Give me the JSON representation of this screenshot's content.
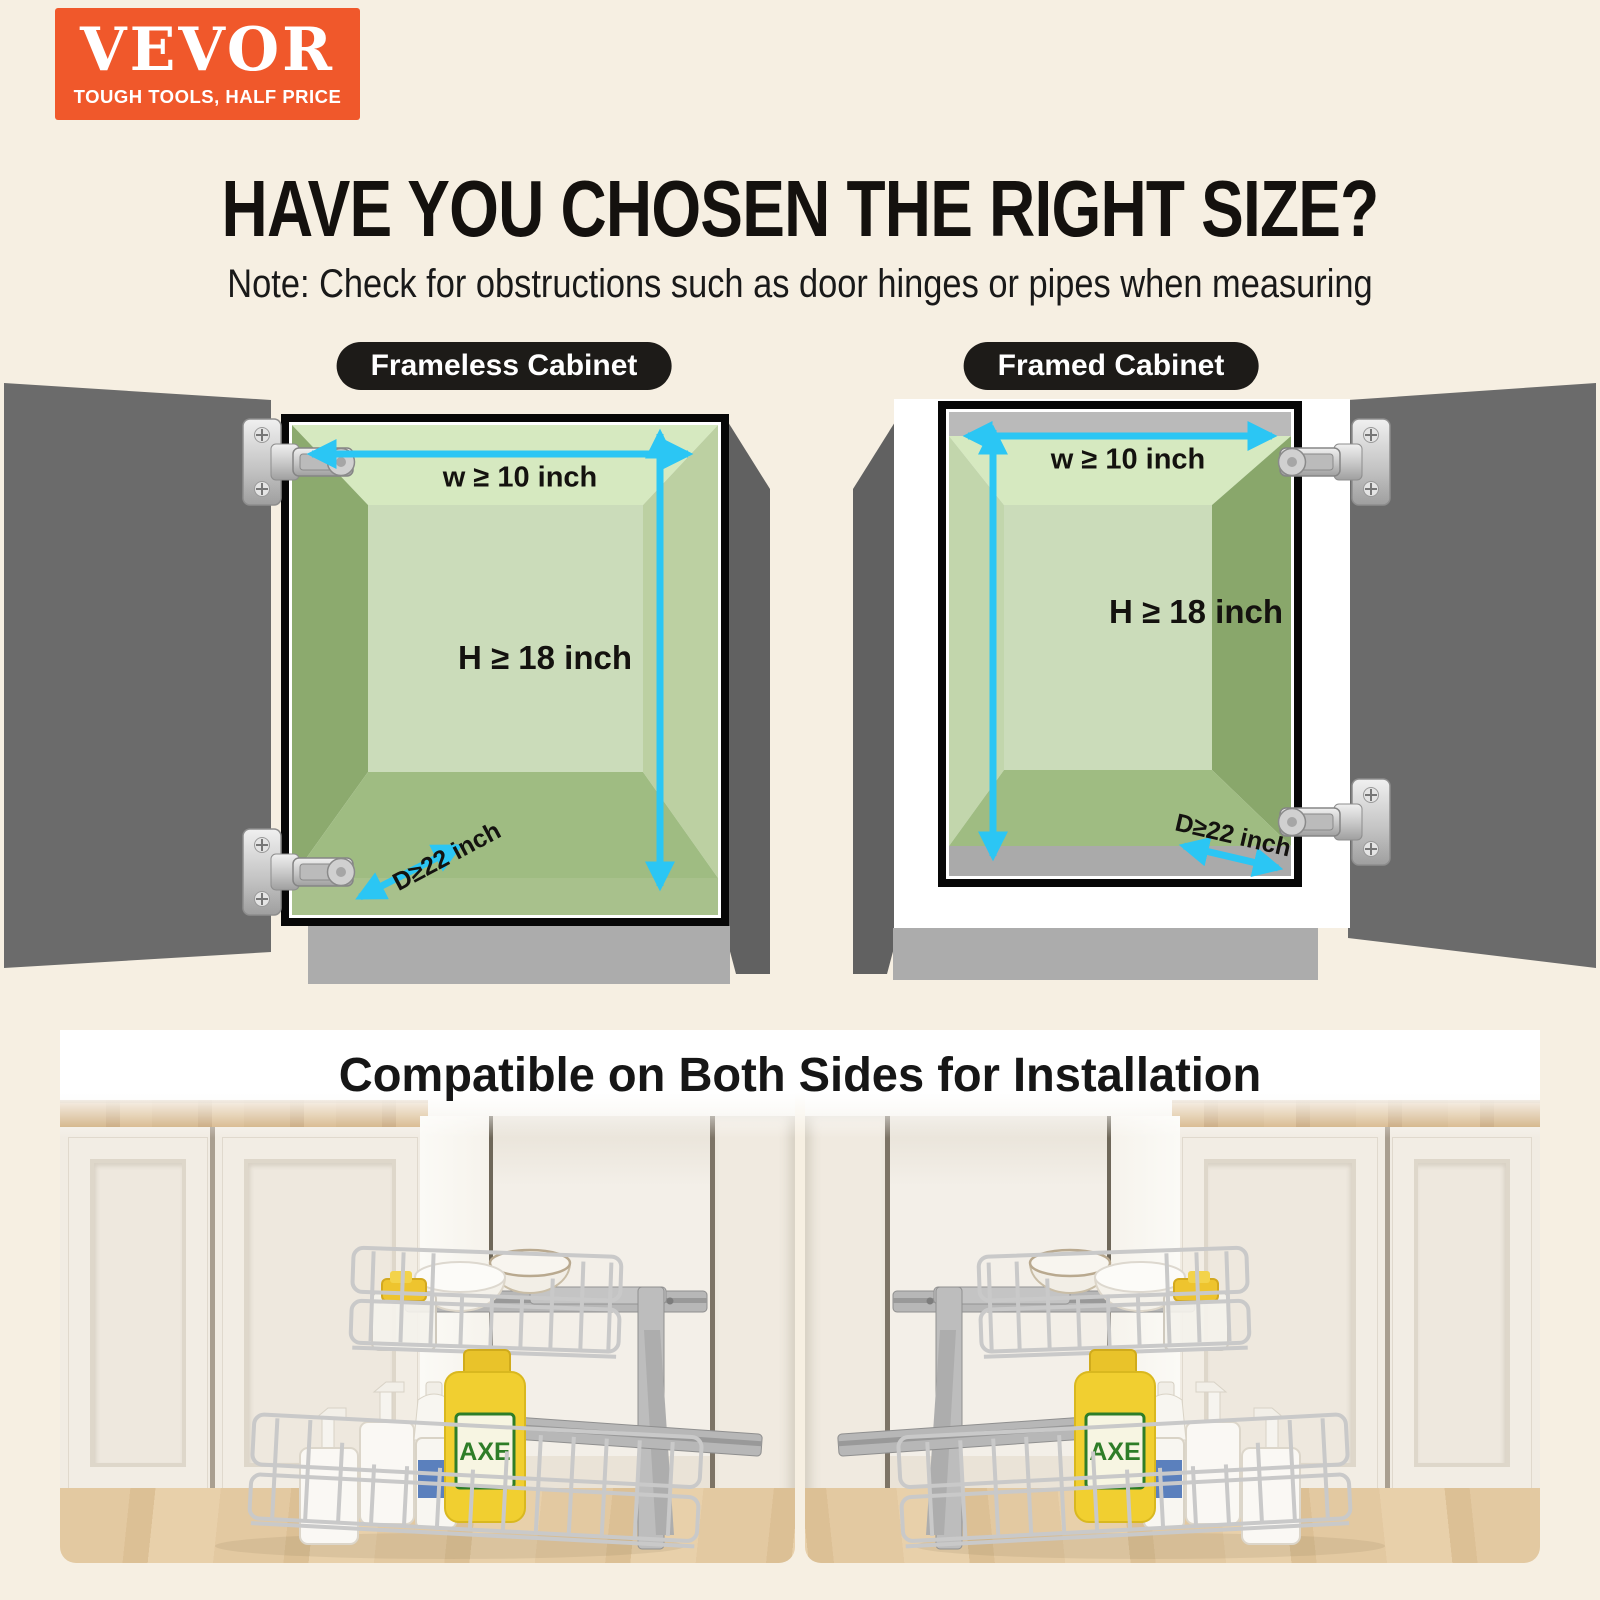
{
  "brand": {
    "name": "VEVOR",
    "tagline": "TOUGH TOOLS, HALF PRICE"
  },
  "header": {
    "title": "HAVE YOU CHOSEN THE RIGHT SIZE?",
    "note": "Note: Check for obstructions such as door hinges or pipes when measuring"
  },
  "diagrams": {
    "frameless": {
      "label": "Frameless Cabinet",
      "width": "w ≥ 10 inch",
      "height": "H ≥ 18 inch",
      "depth": "D≥22 inch"
    },
    "framed": {
      "label": "Framed Cabinet",
      "width": "w ≥ 10 inch",
      "height": "H ≥ 18 inch",
      "depth": "D≥22 inch"
    }
  },
  "installation": {
    "title": "Compatible on Both Sides for Installation",
    "bottle_label": "AXE"
  },
  "colors": {
    "brand_orange": "#F0582B",
    "arrow_cyan": "#2BC6F4",
    "pill_black": "#1D1B18",
    "background_cream": "#F6EFE2",
    "door_gray": "#6B6B6B",
    "cabinet_green_light": "#D6E9C0",
    "cabinet_green_dark": "#8CAA6E",
    "axe_yellow": "#F1CF30"
  }
}
